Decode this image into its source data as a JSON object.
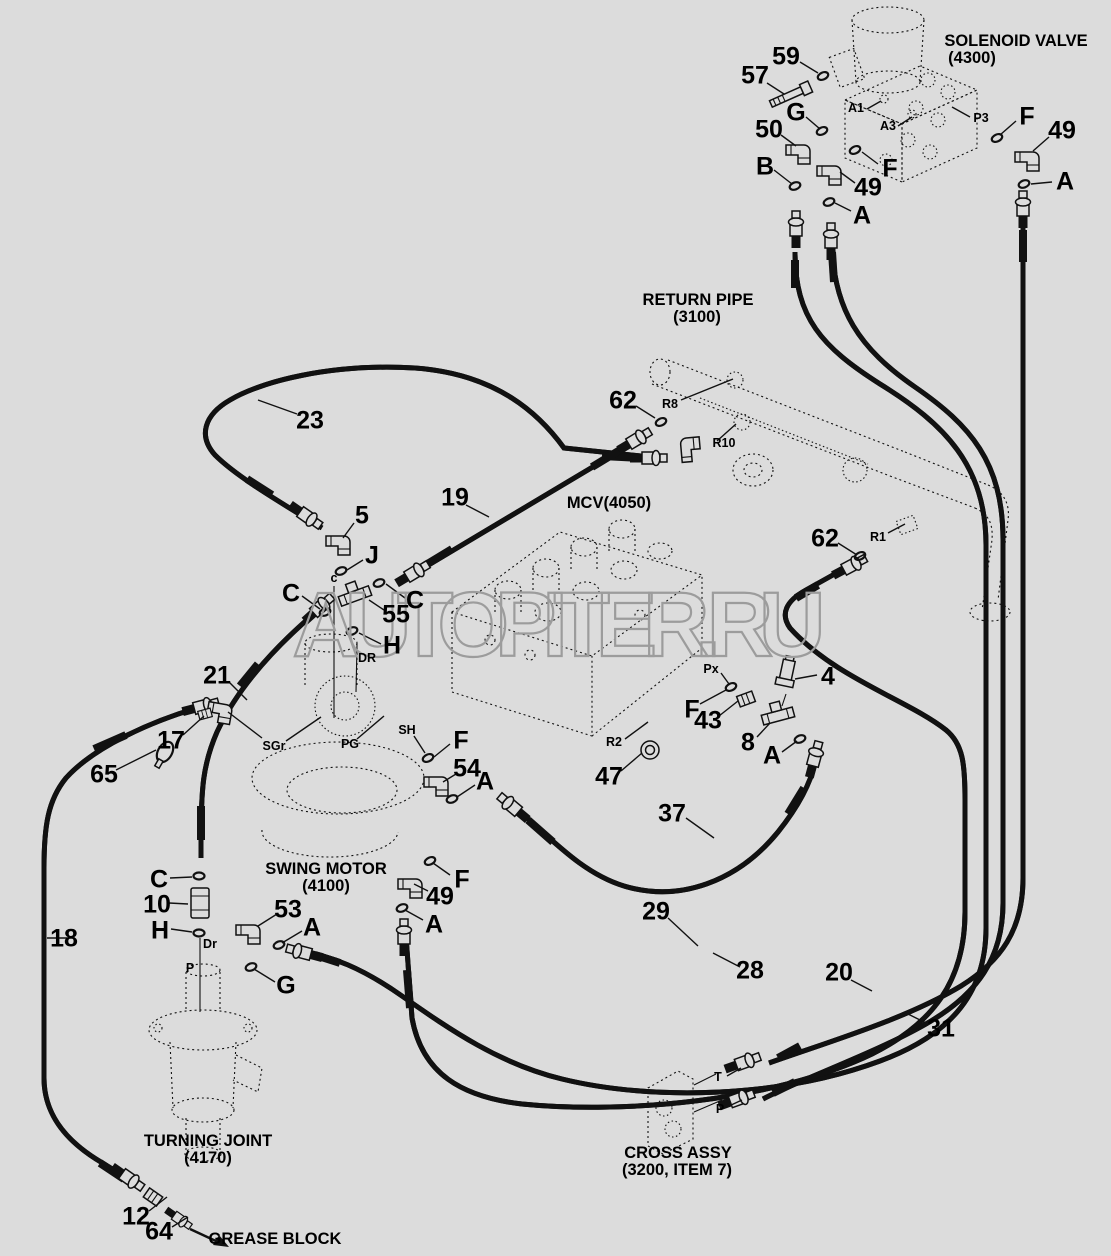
{
  "colors": {
    "background": "#dcdcdc",
    "line": "#111111",
    "watermark": "#9c9c9c"
  },
  "watermark": "AUTOPITER.RU",
  "components": [
    {
      "name": "solenoid-valve",
      "title": "SOLENOID VALVE",
      "code": "(4300)"
    },
    {
      "name": "return-pipe",
      "title": "RETURN PIPE",
      "code": "(3100)"
    },
    {
      "name": "mcv",
      "title": "MCV(4050)",
      "code": ""
    },
    {
      "name": "swing-motor",
      "title": "SWING MOTOR",
      "code": "(4100)"
    },
    {
      "name": "turning-joint",
      "title": "TURNING JOINT",
      "code": "(4170)"
    },
    {
      "name": "cross-assy",
      "title": "CROSS ASSY",
      "code": "(3200, ITEM 7)"
    },
    {
      "name": "grease-block",
      "title": "GREASE BLOCK",
      "code": ""
    }
  ],
  "labels": [
    {
      "name": "callout-59",
      "text": "59",
      "x": 786,
      "y": 57,
      "kind": "num"
    },
    {
      "name": "callout-57",
      "text": "57",
      "x": 755,
      "y": 76,
      "kind": "num"
    },
    {
      "name": "callout-50",
      "text": "50",
      "x": 769,
      "y": 130,
      "kind": "num"
    },
    {
      "name": "callout-49-top-left",
      "text": "49",
      "x": 868,
      "y": 188,
      "kind": "num"
    },
    {
      "name": "callout-49-top-right",
      "text": "49",
      "x": 1062,
      "y": 131,
      "kind": "num"
    },
    {
      "name": "callout-23",
      "text": "23",
      "x": 310,
      "y": 421,
      "kind": "num"
    },
    {
      "name": "callout-19",
      "text": "19",
      "x": 455,
      "y": 498,
      "kind": "num"
    },
    {
      "name": "callout-5",
      "text": "5",
      "x": 362,
      "y": 516,
      "kind": "num"
    },
    {
      "name": "callout-55",
      "text": "55",
      "x": 396,
      "y": 615,
      "kind": "num"
    },
    {
      "name": "callout-62-left",
      "text": "62",
      "x": 623,
      "y": 401,
      "kind": "num"
    },
    {
      "name": "callout-62-right",
      "text": "62",
      "x": 825,
      "y": 539,
      "kind": "num"
    },
    {
      "name": "callout-21",
      "text": "21",
      "x": 217,
      "y": 676,
      "kind": "num"
    },
    {
      "name": "callout-17",
      "text": "17",
      "x": 171,
      "y": 741,
      "kind": "num"
    },
    {
      "name": "callout-65",
      "text": "65",
      "x": 104,
      "y": 775,
      "kind": "num"
    },
    {
      "name": "callout-4",
      "text": "4",
      "x": 828,
      "y": 677,
      "kind": "num"
    },
    {
      "name": "callout-43",
      "text": "43",
      "x": 708,
      "y": 721,
      "kind": "num"
    },
    {
      "name": "callout-8",
      "text": "8",
      "x": 748,
      "y": 743,
      "kind": "num"
    },
    {
      "name": "callout-47",
      "text": "47",
      "x": 609,
      "y": 777,
      "kind": "num"
    },
    {
      "name": "callout-54",
      "text": "54",
      "x": 467,
      "y": 769,
      "kind": "num"
    },
    {
      "name": "callout-37",
      "text": "37",
      "x": 672,
      "y": 814,
      "kind": "num"
    },
    {
      "name": "callout-10",
      "text": "10",
      "x": 157,
      "y": 905,
      "kind": "num"
    },
    {
      "name": "callout-53",
      "text": "53",
      "x": 288,
      "y": 910,
      "kind": "num"
    },
    {
      "name": "callout-49-low",
      "text": "49",
      "x": 440,
      "y": 897,
      "kind": "num"
    },
    {
      "name": "callout-18",
      "text": "18",
      "x": 64,
      "y": 939,
      "kind": "num"
    },
    {
      "name": "callout-29",
      "text": "29",
      "x": 656,
      "y": 912,
      "kind": "num"
    },
    {
      "name": "callout-28",
      "text": "28",
      "x": 750,
      "y": 971,
      "kind": "num"
    },
    {
      "name": "callout-20",
      "text": "20",
      "x": 839,
      "y": 973,
      "kind": "num"
    },
    {
      "name": "callout-31",
      "text": "31",
      "x": 941,
      "y": 1029,
      "kind": "num"
    },
    {
      "name": "callout-12",
      "text": "12",
      "x": 136,
      "y": 1217,
      "kind": "num"
    },
    {
      "name": "callout-64",
      "text": "64",
      "x": 159,
      "y": 1232,
      "kind": "num"
    },
    {
      "name": "callout-G-top",
      "text": "G",
      "x": 796,
      "y": 113,
      "kind": "num"
    },
    {
      "name": "callout-B",
      "text": "B",
      "x": 765,
      "y": 167,
      "kind": "num"
    },
    {
      "name": "callout-F-mid-top",
      "text": "F",
      "x": 890,
      "y": 169,
      "kind": "num"
    },
    {
      "name": "callout-A-top-left",
      "text": "A",
      "x": 862,
      "y": 216,
      "kind": "num"
    },
    {
      "name": "callout-F-top-right",
      "text": "F",
      "x": 1027,
      "y": 117,
      "kind": "num"
    },
    {
      "name": "callout-A-top-right",
      "text": "A",
      "x": 1065,
      "y": 182,
      "kind": "num"
    },
    {
      "name": "callout-J",
      "text": "J",
      "x": 372,
      "y": 556,
      "kind": "num"
    },
    {
      "name": "callout-C-left",
      "text": "C",
      "x": 291,
      "y": 594,
      "kind": "num"
    },
    {
      "name": "callout-C-right",
      "text": "C",
      "x": 415,
      "y": 601,
      "kind": "num"
    },
    {
      "name": "callout-H-tee",
      "text": "H",
      "x": 392,
      "y": 646,
      "kind": "num"
    },
    {
      "name": "callout-C-hose21",
      "text": "C",
      "x": 159,
      "y": 880,
      "kind": "num"
    },
    {
      "name": "callout-H-hose21",
      "text": "H",
      "x": 160,
      "y": 931,
      "kind": "num"
    },
    {
      "name": "callout-F-sh",
      "text": "F",
      "x": 461,
      "y": 741,
      "kind": "num"
    },
    {
      "name": "callout-A-54",
      "text": "A",
      "x": 485,
      "y": 782,
      "kind": "num"
    },
    {
      "name": "callout-F-49low",
      "text": "F",
      "x": 462,
      "y": 880,
      "kind": "num"
    },
    {
      "name": "callout-A-49low",
      "text": "A",
      "x": 434,
      "y": 925,
      "kind": "num"
    },
    {
      "name": "callout-A-53",
      "text": "A",
      "x": 312,
      "y": 928,
      "kind": "num"
    },
    {
      "name": "callout-G-low",
      "text": "G",
      "x": 286,
      "y": 986,
      "kind": "num"
    },
    {
      "name": "callout-F-43",
      "text": "F",
      "x": 692,
      "y": 710,
      "kind": "num"
    },
    {
      "name": "callout-A-8",
      "text": "A",
      "x": 772,
      "y": 756,
      "kind": "num"
    },
    {
      "name": "port-A1",
      "text": "A1",
      "x": 856,
      "y": 108,
      "kind": "port"
    },
    {
      "name": "port-A3",
      "text": "A3",
      "x": 888,
      "y": 126,
      "kind": "port"
    },
    {
      "name": "port-P3",
      "text": "P3",
      "x": 981,
      "y": 118,
      "kind": "port"
    },
    {
      "name": "port-R8",
      "text": "R8",
      "x": 670,
      "y": 404,
      "kind": "port"
    },
    {
      "name": "port-R10",
      "text": "R10",
      "x": 724,
      "y": 443,
      "kind": "port"
    },
    {
      "name": "port-R1",
      "text": "R1",
      "x": 878,
      "y": 537,
      "kind": "port"
    },
    {
      "name": "port-Px",
      "text": "Px",
      "x": 711,
      "y": 669,
      "kind": "port"
    },
    {
      "name": "port-R2",
      "text": "R2",
      "x": 614,
      "y": 742,
      "kind": "port"
    },
    {
      "name": "port-SH",
      "text": "SH",
      "x": 407,
      "y": 730,
      "kind": "port"
    },
    {
      "name": "port-SGr",
      "text": "SGr",
      "x": 274,
      "y": 746,
      "kind": "port"
    },
    {
      "name": "port-PG",
      "text": "PG",
      "x": 350,
      "y": 744,
      "kind": "port"
    },
    {
      "name": "port-DR",
      "text": "DR",
      "x": 367,
      "y": 658,
      "kind": "port"
    },
    {
      "name": "port-c",
      "text": "c",
      "x": 334,
      "y": 578,
      "kind": "port"
    },
    {
      "name": "port-Dr",
      "text": "Dr",
      "x": 210,
      "y": 944,
      "kind": "port"
    },
    {
      "name": "port-P-joint",
      "text": "P",
      "x": 190,
      "y": 968,
      "kind": "port"
    },
    {
      "name": "port-T",
      "text": "T",
      "x": 718,
      "y": 1077,
      "kind": "port"
    },
    {
      "name": "port-P-cross",
      "text": "P",
      "x": 720,
      "y": 1109,
      "kind": "port"
    },
    {
      "name": "solenoid-valve-title",
      "text": "SOLENOID VALVE",
      "x": 1016,
      "y": 41,
      "kind": "title"
    },
    {
      "name": "solenoid-valve-code",
      "text": "(4300)",
      "x": 972,
      "y": 58,
      "kind": "title"
    },
    {
      "name": "return-pipe-title",
      "text": "RETURN PIPE",
      "x": 698,
      "y": 300,
      "kind": "title"
    },
    {
      "name": "return-pipe-code",
      "text": "(3100)",
      "x": 697,
      "y": 317,
      "kind": "title"
    },
    {
      "name": "mcv-title",
      "text": "MCV(4050)",
      "x": 609,
      "y": 503,
      "kind": "title"
    },
    {
      "name": "swing-motor-title",
      "text": "SWING MOTOR",
      "x": 326,
      "y": 869,
      "kind": "title"
    },
    {
      "name": "swing-motor-code",
      "text": "(4100)",
      "x": 326,
      "y": 886,
      "kind": "title"
    },
    {
      "name": "turning-joint-title",
      "text": "TURNING JOINT",
      "x": 208,
      "y": 1141,
      "kind": "title"
    },
    {
      "name": "turning-joint-code",
      "text": "(4170)",
      "x": 208,
      "y": 1158,
      "kind": "title"
    },
    {
      "name": "cross-assy-title",
      "text": "CROSS ASSY",
      "x": 678,
      "y": 1153,
      "kind": "title"
    },
    {
      "name": "cross-assy-code",
      "text": "(3200, ITEM 7)",
      "x": 677,
      "y": 1170,
      "kind": "title"
    },
    {
      "name": "grease-block-title",
      "text": "GREASE BLOCK",
      "x": 275,
      "y": 1239,
      "kind": "title"
    }
  ]
}
